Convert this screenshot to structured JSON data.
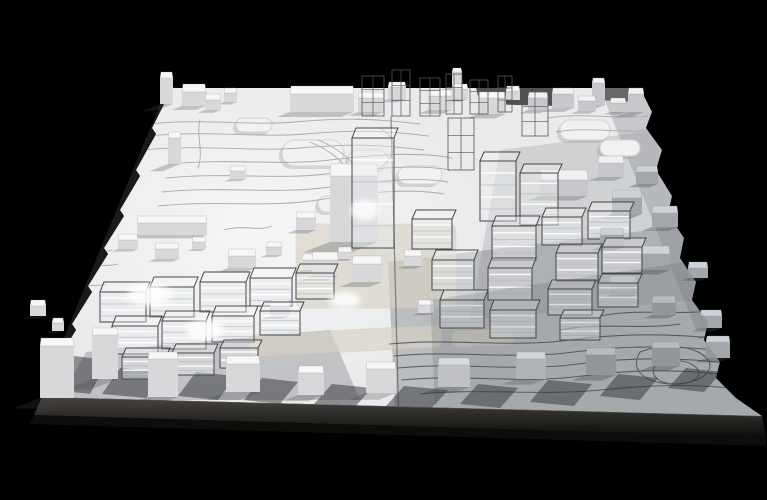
{
  "scene": {
    "name": "architectural-site-massing-model-photo",
    "background": "#000000",
    "colors": {
      "board_base": "#e9eaeb",
      "board_glow": "#ffffff",
      "plinth_top": "#47443f",
      "plinth_bottom": "#0e0d0c",
      "plinth_edge_highlight": "#7a7672",
      "side_band": "#1a1918",
      "brown_sliver": "#3a2d23",
      "contour_light": "#a9aaac",
      "contour_dark": "#5d6165",
      "seam": "rgba(55,57,60,0.55)",
      "wire_stroke": "#46464a",
      "wire_fill_front": "rgba(232,234,238,0.45)",
      "wire_fill_top": "rgba(248,249,250,0.35)",
      "wire_floor_light": "#ffffff",
      "wire_floor_dark": "#b8bcc2",
      "scaffold_stroke": "#55565a",
      "solid_tops": [
        "#f7f7f8",
        "#eef0f1",
        "#ced2d6"
      ],
      "solid_fronts": [
        "#d8d8da",
        "#c6c8cb",
        "#a3a7ab"
      ],
      "cast_shadow": "rgba(62,66,71,0.38)",
      "front_wedge": "rgba(45,48,52,0.5)",
      "mound_fill": "#f1f1f2",
      "mound_stroke": "#d2d3d5",
      "mound_shadow": "rgba(120,124,128,0.25)",
      "beige": "#d8d2c5",
      "beige_stroke": "#c9c2b4",
      "overlay_top": "rgba(60,66,73,0.16)"
    },
    "board": {
      "outline": "172,88 640,88 652,112 646,128 662,150 656,170 672,196 668,214 684,238 680,258 696,282 692,300 708,322 704,340 720,362 716,378 736,398 762,416 42,397 60,368 56,362 76,330 72,324 92,292 88,286 108,254 104,248 124,216 120,210 140,176 136,170 156,134 152,128 168,96"
    },
    "plinth": {
      "front": "42,397 762,416 766,437 34,415",
      "lower": "34,415 766,437 766,446 30,424",
      "edge_line": "M42,397 L762,416"
    },
    "side_band": "166,90 176,86 52,400 40,396",
    "brown_sliver": "646,194 656,196 678,258 668,260",
    "seam": {
      "x1": 391,
      "y1": 116,
      "x2": 399,
      "y2": 430
    },
    "overlays_under": [
      {
        "points": "388,262 767,216 767,430 396,430",
        "fill": "rgba(88,93,99,0.32)"
      },
      {
        "points": "600,88 648,88 767,300 696,330",
        "fill": "rgba(120,124,128,0.30)"
      },
      {
        "points": "500,150 660,130 700,300 470,320",
        "fill": "rgba(140,144,150,0.28)"
      },
      {
        "points": "86,352 330,330 360,400 60,400",
        "fill": "rgba(95,100,106,0.30)"
      }
    ],
    "dark_patches": [
      {
        "points": "476,88 560,88 556,106 480,104",
        "fill": "rgba(32,30,28,0.75)"
      },
      {
        "points": "596,88 640,88 636,102 600,100",
        "fill": "rgba(40,36,32,0.6)"
      }
    ],
    "contours": {
      "upper": [
        "M150,124 C200,118 250,126 295,122 S370,118 420,124",
        "M146,136 C210,130 258,138 305,134 S380,130 428,136",
        "M142,150 C206,144 252,152 300,148 S376,144 424,150",
        "M170,164 C230,158 280,166 330,160 S420,152 452,158",
        "M166,178 C226,172 276,180 326,174 S418,164 450,170",
        "M162,192 C222,186 272,194 322,188 S414,176 448,182",
        "M158,206 C218,200 268,208 318,200 S410,188 444,194",
        "M380,128 C400,140 396,156 380,168",
        "M200,120 C196,136 204,152 198,168",
        "M310,142 C330,150 344,162 352,176",
        "M318,140 C338,148 352,160 360,174",
        "M548,118 C584,112 616,120 648,116",
        "M556,132 C590,126 620,134 650,130"
      ],
      "left": [
        "M64,252 C84,248 98,254 112,250",
        "M70,266 C90,262 104,268 118,264",
        "M58,286 C78,282 92,288 106,284",
        "M224,230 C244,224 258,232 272,226"
      ],
      "lower": [
        "M390,344 C450,338 510,348 570,340 S690,334 744,342",
        "M394,356 C454,350 514,360 574,352 S694,346 746,354",
        "M398,368 C458,362 518,372 578,364 S696,358 748,366",
        "M402,380 C462,374 522,384 582,376 S700,370 750,378",
        "M420,394 C480,388 540,396 600,390 S704,384 746,390",
        "M560,330 C600,322 640,330 680,324",
        "M600,316 C640,308 680,316 716,310"
      ],
      "swirls": [
        "M640,352 c26,-10 58,-6 68,8 c8,12 -10,24 -34,24 c-26,0 -46,-12 -34,-32",
        "M656,364 c16,-6 36,-4 42,6 c4,8 -8,14 -22,14 c-16,0 -28,-8 -20,-20",
        "M700,338 c20,-8 44,-4 52,8"
      ]
    },
    "mounds": [
      [
        282,
        140,
        62,
        26
      ],
      [
        348,
        150,
        40,
        20
      ],
      [
        398,
        166,
        44,
        18
      ],
      [
        318,
        196,
        36,
        16
      ],
      [
        560,
        120,
        50,
        20
      ],
      [
        600,
        140,
        40,
        16
      ],
      [
        236,
        118,
        36,
        14
      ]
    ],
    "beige_patches": [
      [
        296,
        224,
        160,
        84,
        0
      ],
      [
        250,
        330,
        192,
        22,
        -3
      ],
      [
        452,
        330,
        62,
        16,
        -2
      ]
    ],
    "front_shadows": [
      [
        120,
        368,
        44,
        26
      ],
      [
        196,
        372,
        40,
        24
      ],
      [
        262,
        378,
        36,
        22
      ],
      [
        332,
        384,
        40,
        20
      ],
      [
        404,
        386,
        44,
        20
      ],
      [
        478,
        384,
        40,
        20
      ],
      [
        548,
        380,
        44,
        22
      ],
      [
        618,
        374,
        40,
        22
      ],
      [
        686,
        368,
        36,
        20
      ],
      [
        74,
        356,
        34,
        34
      ]
    ],
    "solid_buildings": [
      [
        160,
        72,
        13,
        6,
        26,
        0
      ],
      [
        182,
        84,
        24,
        8,
        14,
        0
      ],
      [
        205,
        94,
        16,
        6,
        10,
        0
      ],
      [
        224,
        88,
        13,
        5,
        9,
        0
      ],
      [
        290,
        86,
        64,
        8,
        18,
        0
      ],
      [
        358,
        92,
        26,
        6,
        14,
        0
      ],
      [
        388,
        82,
        18,
        5,
        12,
        0
      ],
      [
        428,
        90,
        24,
        6,
        14,
        0
      ],
      [
        452,
        84,
        16,
        5,
        10,
        0
      ],
      [
        478,
        92,
        28,
        6,
        16,
        0
      ],
      [
        506,
        86,
        14,
        5,
        9,
        0
      ],
      [
        452,
        68,
        10,
        4,
        14,
        0
      ],
      [
        528,
        92,
        20,
        6,
        12,
        1
      ],
      [
        552,
        88,
        22,
        6,
        14,
        1
      ],
      [
        578,
        96,
        18,
        5,
        10,
        1
      ],
      [
        592,
        78,
        13,
        5,
        22,
        1
      ],
      [
        610,
        98,
        16,
        5,
        9,
        1
      ],
      [
        628,
        88,
        16,
        6,
        18,
        1
      ],
      [
        168,
        132,
        13,
        6,
        26,
        0
      ],
      [
        137,
        216,
        70,
        7,
        12,
        0
      ],
      [
        230,
        166,
        16,
        5,
        8,
        0
      ],
      [
        118,
        234,
        20,
        6,
        9,
        0
      ],
      [
        155,
        243,
        24,
        6,
        10,
        0
      ],
      [
        192,
        237,
        14,
        5,
        7,
        0
      ],
      [
        228,
        249,
        28,
        7,
        12,
        0
      ],
      [
        266,
        242,
        16,
        5,
        8,
        0
      ],
      [
        302,
        254,
        22,
        6,
        10,
        0
      ],
      [
        338,
        247,
        14,
        5,
        7,
        0
      ],
      [
        330,
        164,
        48,
        12,
        66,
        0
      ],
      [
        312,
        252,
        26,
        8,
        16,
        0
      ],
      [
        352,
        256,
        30,
        8,
        18,
        0
      ],
      [
        404,
        250,
        18,
        6,
        10,
        0
      ],
      [
        296,
        212,
        20,
        6,
        12,
        0
      ],
      [
        540,
        170,
        48,
        10,
        16,
        1
      ],
      [
        598,
        156,
        26,
        7,
        14,
        1
      ],
      [
        636,
        166,
        22,
        6,
        12,
        2
      ],
      [
        612,
        190,
        30,
        8,
        16,
        2
      ],
      [
        652,
        206,
        26,
        7,
        14,
        2
      ],
      [
        600,
        228,
        24,
        7,
        12,
        2
      ],
      [
        640,
        246,
        30,
        8,
        16,
        2
      ],
      [
        610,
        276,
        26,
        7,
        12,
        2
      ],
      [
        652,
        296,
        24,
        7,
        12,
        2
      ],
      [
        688,
        262,
        20,
        6,
        10,
        2
      ],
      [
        700,
        310,
        22,
        6,
        12,
        2
      ],
      [
        40,
        338,
        34,
        8,
        52,
        0
      ],
      [
        92,
        328,
        26,
        7,
        44,
        0
      ],
      [
        148,
        352,
        30,
        7,
        38,
        0
      ],
      [
        226,
        356,
        34,
        8,
        28,
        0
      ],
      [
        298,
        366,
        26,
        7,
        22,
        0
      ],
      [
        366,
        362,
        30,
        7,
        24,
        0
      ],
      [
        438,
        358,
        32,
        7,
        22,
        0
      ],
      [
        516,
        352,
        30,
        7,
        20,
        1
      ],
      [
        586,
        348,
        30,
        7,
        20,
        2
      ],
      [
        652,
        342,
        28,
        6,
        18,
        2
      ],
      [
        706,
        336,
        24,
        6,
        16,
        2
      ],
      [
        30,
        300,
        16,
        6,
        10,
        0
      ],
      [
        52,
        318,
        12,
        5,
        8,
        0
      ],
      [
        270,
        300,
        20,
        6,
        10,
        0
      ],
      [
        418,
        300,
        16,
        5,
        8,
        0
      ]
    ],
    "wire_buildings": [
      [
        100,
        282,
        46,
        10,
        30
      ],
      [
        150,
        277,
        44,
        10,
        30
      ],
      [
        200,
        272,
        46,
        10,
        30
      ],
      [
        250,
        268,
        42,
        10,
        28
      ],
      [
        296,
        264,
        38,
        9,
        26
      ],
      [
        112,
        316,
        46,
        10,
        28
      ],
      [
        162,
        311,
        44,
        10,
        28
      ],
      [
        212,
        306,
        42,
        10,
        26
      ],
      [
        260,
        302,
        40,
        9,
        24
      ],
      [
        122,
        348,
        44,
        9,
        22
      ],
      [
        172,
        344,
        42,
        9,
        22
      ],
      [
        220,
        340,
        38,
        8,
        20
      ],
      [
        352,
        128,
        42,
        10,
        110
      ],
      [
        412,
        210,
        40,
        9,
        30
      ],
      [
        432,
        250,
        42,
        10,
        30
      ],
      [
        440,
        290,
        44,
        10,
        28
      ],
      [
        480,
        152,
        36,
        9,
        60
      ],
      [
        520,
        164,
        38,
        9,
        52
      ],
      [
        492,
        216,
        44,
        10,
        34
      ],
      [
        488,
        258,
        44,
        10,
        32
      ],
      [
        490,
        300,
        46,
        10,
        28
      ],
      [
        542,
        208,
        40,
        9,
        28
      ],
      [
        588,
        202,
        42,
        9,
        28
      ],
      [
        556,
        244,
        42,
        9,
        28
      ],
      [
        602,
        238,
        40,
        9,
        26
      ],
      [
        548,
        280,
        44,
        9,
        26
      ],
      [
        598,
        274,
        40,
        9,
        24
      ],
      [
        560,
        310,
        40,
        8,
        22
      ]
    ],
    "scaffolds": [
      [
        362,
        76,
        22,
        40
      ],
      [
        392,
        70,
        18,
        46
      ],
      [
        420,
        78,
        20,
        38
      ],
      [
        446,
        74,
        16,
        40
      ],
      [
        470,
        80,
        18,
        34
      ],
      [
        498,
        76,
        14,
        36
      ],
      [
        522,
        92,
        26,
        44
      ],
      [
        448,
        118,
        26,
        52
      ]
    ],
    "glows": [
      [
        150,
        295,
        22,
        11
      ],
      [
        205,
        330,
        19,
        10
      ],
      [
        345,
        300,
        16,
        8
      ],
      [
        365,
        210,
        14,
        10
      ]
    ],
    "overlay_top_points": "430,300 767,250 767,428 436,428"
  }
}
